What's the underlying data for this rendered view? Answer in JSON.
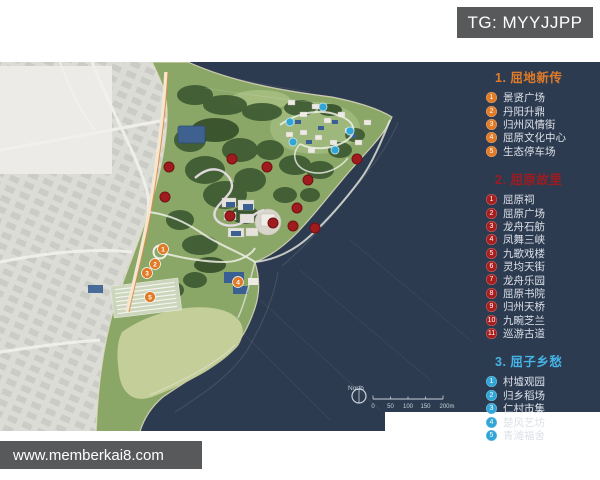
{
  "watermark": {
    "text": "TG: MYYJJPP"
  },
  "footer": {
    "text": "www.memberkai8.com"
  },
  "legend": {
    "sections": [
      {
        "num": "1.",
        "title": "屈地新传",
        "color": "#e07b28",
        "badge": "#e07b28",
        "items": [
          {
            "n": "1",
            "label": "景贤广场"
          },
          {
            "n": "2",
            "label": "丹阳升鼎"
          },
          {
            "n": "3",
            "label": "归州风情街"
          },
          {
            "n": "4",
            "label": "屈原文化中心"
          },
          {
            "n": "5",
            "label": "生态停车场"
          }
        ]
      },
      {
        "num": "2.",
        "title": "屈原故里",
        "color": "#9e1c20",
        "badge": "#a81e1e",
        "items": [
          {
            "n": "1",
            "label": "屈原祠"
          },
          {
            "n": "2",
            "label": "屈原广场"
          },
          {
            "n": "3",
            "label": "龙舟石舫"
          },
          {
            "n": "4",
            "label": "凤舞三峡"
          },
          {
            "n": "5",
            "label": "九歌戏楼"
          },
          {
            "n": "6",
            "label": "灵均天街"
          },
          {
            "n": "7",
            "label": "龙舟乐园"
          },
          {
            "n": "8",
            "label": "屈原书院"
          },
          {
            "n": "9",
            "label": "归州天桥"
          },
          {
            "n": "10",
            "label": "九畹芝兰"
          },
          {
            "n": "11",
            "label": "巡游古道"
          }
        ]
      },
      {
        "num": "3.",
        "title": "屈子乡愁",
        "color": "#45b4e6",
        "badge": "#31a5d6",
        "items": [
          {
            "n": "1",
            "label": "村墟观园"
          },
          {
            "n": "2",
            "label": "归乡稻场"
          },
          {
            "n": "3",
            "label": "仁村市集"
          },
          {
            "n": "4",
            "label": "楚风艺坊"
          },
          {
            "n": "5",
            "label": "青滩福舍"
          }
        ]
      }
    ]
  },
  "map": {
    "north_label": "North",
    "scale": {
      "labels": [
        "0",
        "50",
        "100",
        "150",
        "200m"
      ]
    },
    "colors": {
      "water": "#2d3b50",
      "red": "#9f1b1e",
      "orange": "#e07b28",
      "blue": "#31a5d6"
    },
    "markers": {
      "red": [
        [
          169,
          167
        ],
        [
          165,
          197
        ],
        [
          232,
          159
        ],
        [
          267,
          167
        ],
        [
          357,
          159
        ],
        [
          308,
          180
        ],
        [
          297,
          208
        ],
        [
          230,
          216
        ],
        [
          273,
          223
        ],
        [
          293,
          226
        ],
        [
          315,
          228
        ]
      ],
      "orange": [
        {
          "n": "1",
          "x": 163,
          "y": 249
        },
        {
          "n": "2",
          "x": 155,
          "y": 264
        },
        {
          "n": "3",
          "x": 147,
          "y": 273
        },
        {
          "n": "4",
          "x": 238,
          "y": 282
        },
        {
          "n": "5",
          "x": 150,
          "y": 297
        }
      ],
      "blue": [
        [
          323,
          107
        ],
        [
          290,
          122
        ],
        [
          350,
          131
        ],
        [
          293,
          142
        ],
        [
          335,
          150
        ]
      ]
    }
  }
}
